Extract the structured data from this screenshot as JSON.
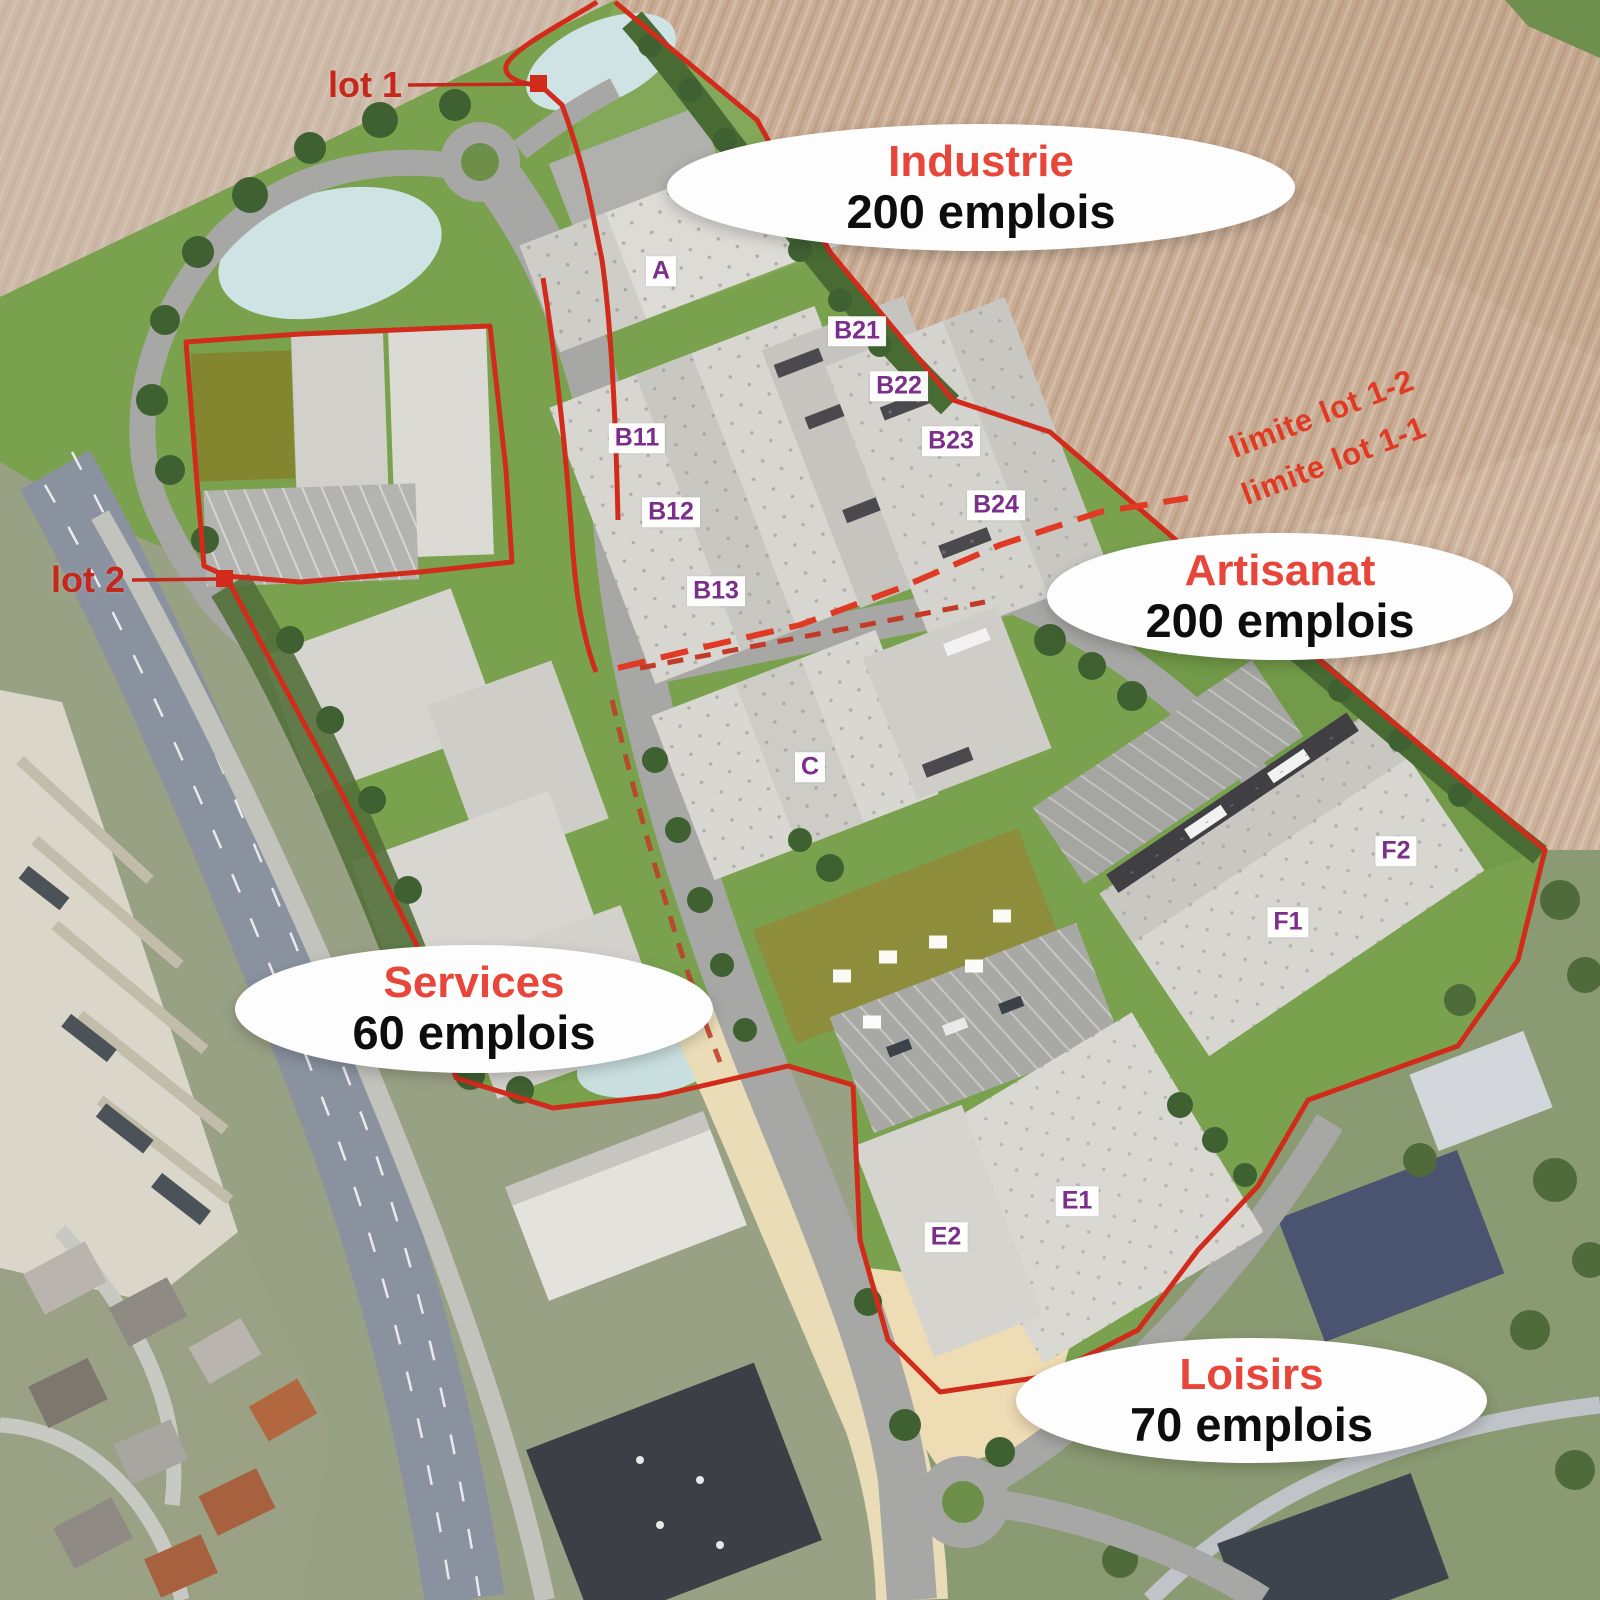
{
  "map_title": "Aerial masterplan of a business park with employment zones",
  "callouts": [
    {
      "id": "industrie",
      "title": "Industrie",
      "value": "200 emplois"
    },
    {
      "id": "artisanat",
      "title": "Artisanat",
      "value": "200 emplois"
    },
    {
      "id": "services",
      "title": "Services",
      "value": "60 emplois"
    },
    {
      "id": "loisirs",
      "title": "Loisirs",
      "value": "70 emplois"
    }
  ],
  "lot_markers": [
    {
      "label": "lot 1"
    },
    {
      "label": "lot 2"
    }
  ],
  "boundary_labels": [
    {
      "label": "limite lot 1-2"
    },
    {
      "label": "limite lot 1-1"
    }
  ],
  "buildings": [
    {
      "label": "A"
    },
    {
      "label": "B11"
    },
    {
      "label": "B12"
    },
    {
      "label": "B13"
    },
    {
      "label": "B21"
    },
    {
      "label": "B22"
    },
    {
      "label": "B23"
    },
    {
      "label": "B24"
    },
    {
      "label": "C"
    },
    {
      "label": "E1"
    },
    {
      "label": "E2"
    },
    {
      "label": "F1"
    },
    {
      "label": "F2"
    }
  ],
  "garden_markers": [
    {
      "label": ""
    },
    {
      "label": ""
    },
    {
      "label": ""
    },
    {
      "label": ""
    },
    {
      "label": ""
    },
    {
      "label": ""
    }
  ],
  "colors": {
    "boundary_red": "#d12c1b",
    "label_purple": "#7b2e8a",
    "callout_title_red": "#e8463a",
    "callout_value_black": "#0d0d0d",
    "site_green": "#7aa24e",
    "farmland_tan": "#c9ad95"
  }
}
